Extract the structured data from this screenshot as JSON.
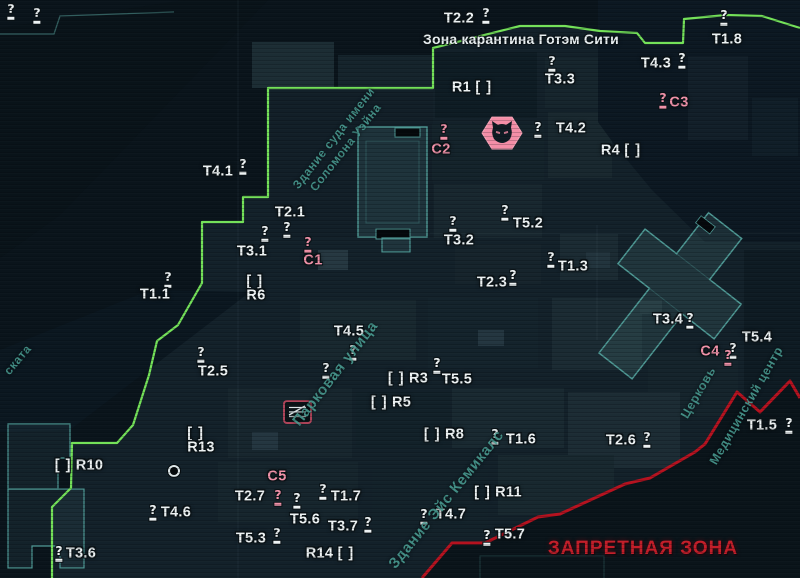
{
  "titles": {
    "quarantine_zone": "Зона карантина Готэм Сити",
    "forbidden_zone": "ЗАПРЕТНАЯ ЗОНА"
  },
  "colors": {
    "quarantine_border_green": "#74e159",
    "forbidden_border_red": "#b5121f",
    "forbidden_text_red": "#c21e29",
    "marker_white": "#edf2f3",
    "catwoman_pink": "#f192a9",
    "building_outline_teal": "#4e9894",
    "street_text_teal": "#4a9e94"
  },
  "icons": {
    "question_glyph": "?",
    "bracket_glyph": "[ ]",
    "catwoman_icon": "cat-head-hexagon",
    "store_icon": "striped-sign"
  },
  "markers": {
    "trophies": [
      {
        "label": "T2.2",
        "x": 459,
        "y": 19,
        "qx": 486,
        "qy": 15
      },
      {
        "label": "T1.8",
        "x": 727,
        "y": 40,
        "qx": 724,
        "qy": 17
      },
      {
        "label": "T4.3",
        "x": 656,
        "y": 64,
        "qx": 682,
        "qy": 60
      },
      {
        "label": "T3.3",
        "x": 560,
        "y": 80,
        "qx": 552,
        "qy": 63
      },
      {
        "label": "T4.2",
        "x": 571,
        "y": 129,
        "qx": 538,
        "qy": 129
      },
      {
        "label": "T4.1",
        "x": 218,
        "y": 172,
        "qx": 243,
        "qy": 166
      },
      {
        "label": "T2.1",
        "x": 290,
        "y": 213,
        "qx": 287,
        "qy": 229
      },
      {
        "label": "T3.1",
        "x": 252,
        "y": 252,
        "qx": 265,
        "qy": 233
      },
      {
        "label": "T5.2",
        "x": 528,
        "y": 224,
        "qx": 505,
        "qy": 212
      },
      {
        "label": "T3.2",
        "x": 459,
        "y": 241,
        "qx": 453,
        "qy": 223
      },
      {
        "label": "T1.3",
        "x": 573,
        "y": 267,
        "qx": 551,
        "qy": 259
      },
      {
        "label": "T2.3",
        "x": 492,
        "y": 283,
        "qx": 513,
        "qy": 277
      },
      {
        "label": "T1.1",
        "x": 155,
        "y": 295,
        "qx": 168,
        "qy": 279
      },
      {
        "label": "T3.4",
        "x": 668,
        "y": 320,
        "qx": 690,
        "qy": 320
      },
      {
        "label": "T5.4",
        "x": 757,
        "y": 338,
        "qx": 733,
        "qy": 350
      },
      {
        "label": "T4.5",
        "x": 349,
        "y": 332,
        "qx": 353,
        "qy": 352
      },
      {
        "label": "T2.5",
        "x": 213,
        "y": 372,
        "qx": 201,
        "qy": 354
      },
      {
        "label": "T5.5",
        "x": 457,
        "y": 380,
        "qx": 437,
        "qy": 365
      },
      {
        "label": "T1.6",
        "x": 521,
        "y": 440,
        "qx": 495,
        "qy": 436
      },
      {
        "label": "T2.6",
        "x": 621,
        "y": 441,
        "qx": 647,
        "qy": 439
      },
      {
        "label": "T1.5",
        "x": 762,
        "y": 426,
        "qx": 789,
        "qy": 425
      },
      {
        "label": "T4.6",
        "x": 176,
        "y": 513,
        "qx": 153,
        "qy": 512
      },
      {
        "label": "T2.7",
        "x": 250,
        "y": 497,
        "qx": 297,
        "qy": 500
      },
      {
        "label": "T1.7",
        "x": 346,
        "y": 497,
        "qx": 323,
        "qy": 491
      },
      {
        "label": "T5.6",
        "x": 305,
        "y": 520
      },
      {
        "label": "T3.7",
        "x": 343,
        "y": 527,
        "qx": 368,
        "qy": 524
      },
      {
        "label": "T5.3",
        "x": 251,
        "y": 539,
        "qx": 277,
        "qy": 535
      },
      {
        "label": "T4.7",
        "x": 451,
        "y": 515,
        "qx": 424,
        "qy": 516
      },
      {
        "label": "T5.7",
        "x": 510,
        "y": 535,
        "qx": 487,
        "qy": 537
      },
      {
        "label": "T3.6",
        "x": 81,
        "y": 554,
        "qx": 59,
        "qy": 553
      }
    ],
    "catwoman": [
      {
        "label": "C1",
        "x": 313,
        "y": 261,
        "qx": 308,
        "qy": 244
      },
      {
        "label": "C2",
        "x": 441,
        "y": 150,
        "qx": 444,
        "qy": 131
      },
      {
        "label": "C3",
        "x": 679,
        "y": 103,
        "qx": 663,
        "qy": 100
      },
      {
        "label": "C4",
        "x": 710,
        "y": 352,
        "qx": 728,
        "qy": 357
      },
      {
        "label": "C5",
        "x": 277,
        "y": 477,
        "qx": 278,
        "qy": 497
      }
    ],
    "riddles": [
      {
        "label": "R1",
        "x": 472,
        "y": 88,
        "bracket": "after"
      },
      {
        "label": "R4",
        "x": 621,
        "y": 151,
        "bracket": "after"
      },
      {
        "label": "R6",
        "x": 256,
        "y": 289,
        "bracket": "above"
      },
      {
        "label": "R3",
        "x": 408,
        "y": 379,
        "bracket": "before"
      },
      {
        "label": "R5",
        "x": 391,
        "y": 403,
        "bracket": "before"
      },
      {
        "label": "R8",
        "x": 444,
        "y": 435,
        "bracket": "before"
      },
      {
        "label": "R13",
        "x": 201,
        "y": 441,
        "bracket": "above"
      },
      {
        "label": "R10",
        "x": 79,
        "y": 466,
        "bracket": "before"
      },
      {
        "label": "R11",
        "x": 498,
        "y": 493,
        "bracket": "before"
      },
      {
        "label": "R14",
        "x": 330,
        "y": 554,
        "bracket": "after"
      }
    ],
    "lone_questions": [
      {
        "x": 326,
        "y": 370
      },
      {
        "x": 11,
        "y": 11
      },
      {
        "x": 37,
        "y": 15
      }
    ],
    "catwoman_icon_pos": {
      "x": 502,
      "y": 133
    },
    "store_icon_pos": {
      "x": 297,
      "y": 412
    },
    "dot_marker": {
      "x": 174,
      "y": 471
    }
  },
  "street_labels": [
    {
      "lines": [
        "Здание суда имени",
        "Соломона Уэйна"
      ],
      "x": 340,
      "y": 143,
      "rotate": -52,
      "size": 12
    },
    {
      "lines": [
        "Парковая улица"
      ],
      "x": 336,
      "y": 374,
      "rotate": -52,
      "size": 15
    },
    {
      "lines": [
        "Церковь"
      ],
      "x": 699,
      "y": 393,
      "rotate": -60,
      "size": 12.5
    },
    {
      "lines": [
        "Медицинский центр"
      ],
      "x": 747,
      "y": 406,
      "rotate": -60,
      "size": 12.5
    },
    {
      "lines": [
        "Здание Эйс Кемикалс"
      ],
      "x": 447,
      "y": 500,
      "rotate": -51,
      "size": 15
    },
    {
      "lines": [
        "ската"
      ],
      "x": 18,
      "y": 360,
      "rotate": -50,
      "size": 12
    }
  ]
}
